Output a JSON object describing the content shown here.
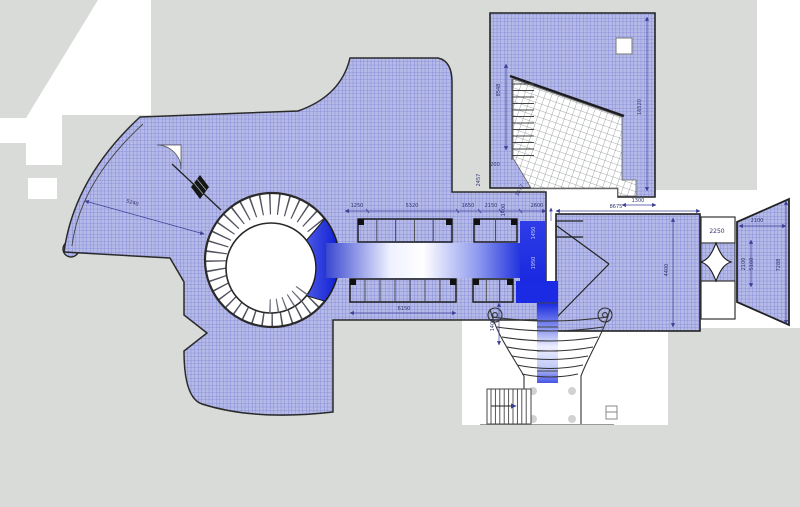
{
  "plan": {
    "kind_label": "",
    "colors": {
      "backdrop_gray": "#d8dbd8",
      "hatch_fill": "#b5bae7",
      "hatch_line": "#7a81d4",
      "deep_blue": "#1b2ae0",
      "dim_line": "#3c3f96",
      "outline": "#222222"
    },
    "dims": {
      "fan_radius": "5240",
      "corridor_top": [
        "1250",
        "5320",
        "1650",
        "2150",
        "1400",
        "2600"
      ],
      "corridor_bottom": "6150",
      "vestibule": [
        "1450",
        "1950",
        "1450"
      ],
      "hall": {
        "width": "8675",
        "notch": "1300",
        "depth": "4400"
      },
      "building": {
        "left": "8548",
        "right": "16520",
        "small": "200",
        "side": "2457",
        "diag": "3677"
      },
      "portal": {
        "box": "2250",
        "top": "2100",
        "v1": "2100",
        "v2": "5160",
        "height": "7288"
      },
      "south_stair": "1400"
    }
  }
}
